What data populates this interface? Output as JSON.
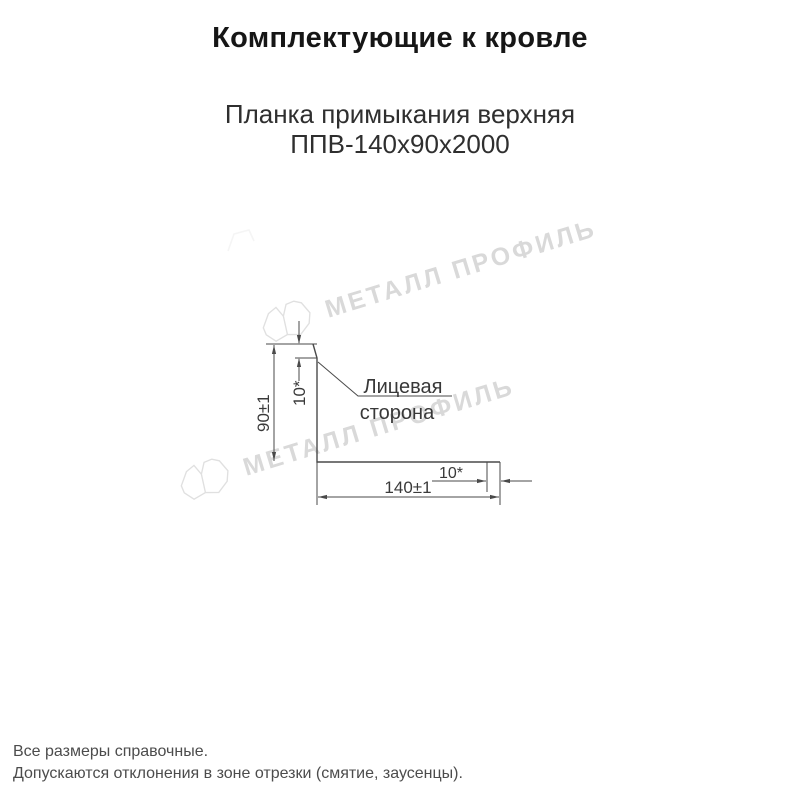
{
  "header": {
    "title": "Комплектующие к кровле",
    "product_line1": "Планка примыкания верхняя",
    "product_line2": "ППВ-140х90х2000"
  },
  "drawing": {
    "dim_height": "90±1",
    "dim_top_flange": "10*",
    "dim_width": "140±1",
    "dim_end_flange": "10*",
    "face_label_line1": "Лицевая",
    "face_label_line2": "сторона"
  },
  "watermark": {
    "text": "МЕТАЛЛ ПРОФИЛЬ",
    "color": "#d9d9d9"
  },
  "footnotes": {
    "line1": "Все размеры справочные.",
    "line2": "Допускаются отклонения в зоне отрезки (смятие, заусенцы)."
  },
  "colors": {
    "line": "#4a4a4a",
    "dim_text": "#3a3a3a",
    "title_text": "#161616"
  }
}
